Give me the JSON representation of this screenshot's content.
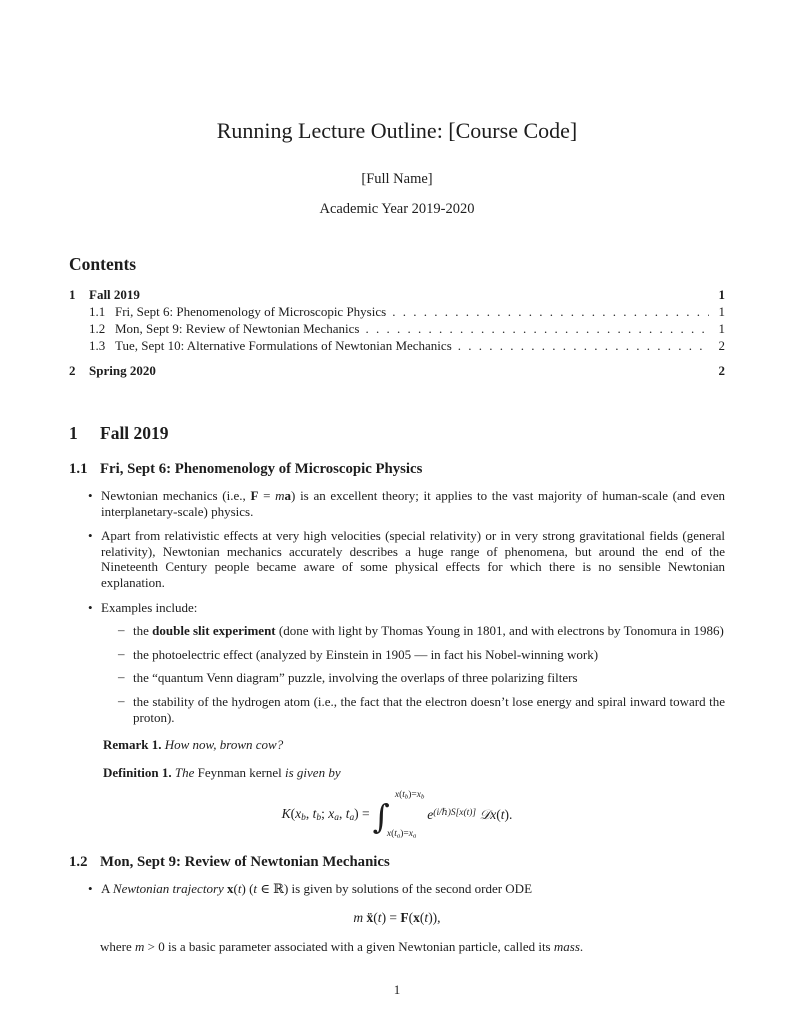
{
  "header": {
    "title": "Running Lecture Outline: [Course Code]",
    "author": "[Full Name]",
    "date": "Academic Year 2019-2020"
  },
  "toc": {
    "heading": "Contents",
    "entries": [
      {
        "num": "1",
        "label": "Fall 2019",
        "page": "1"
      },
      {
        "num": "1.1",
        "label": "Fri, Sept 6: Phenomenology of Microscopic Physics",
        "page": "1"
      },
      {
        "num": "1.2",
        "label": "Mon, Sept 9: Review of Newtonian Mechanics",
        "page": "1"
      },
      {
        "num": "1.3",
        "label": "Tue, Sept 10: Alternative Formulations of Newtonian Mechanics",
        "page": "2"
      },
      {
        "num": "2",
        "label": "Spring 2020",
        "page": "2"
      }
    ]
  },
  "sections": {
    "fall": {
      "num": "1",
      "title": "Fall 2019"
    },
    "sub11": {
      "num": "1.1",
      "title": "Fri, Sept 6: Phenomenology of Microscopic Physics"
    },
    "sub12": {
      "num": "1.2",
      "title": "Mon, Sept 9: Review of Newtonian Mechanics"
    }
  },
  "content": {
    "bullet1": [
      {
        "t": "Newtonian mechanics (i.e., "
      },
      {
        "t": "F",
        "s": "b"
      },
      {
        "t": " = "
      },
      {
        "t": "m",
        "s": "i"
      },
      {
        "t": "a",
        "s": "b"
      },
      {
        "t": ") is an excellent theory; it applies to the vast majority of human-scale (and even interplanetary-scale) physics."
      }
    ],
    "bullet2": [
      {
        "t": "Apart from relativistic effects at very high velocities (special relativity) or in very strong gravitational fields (general relativity), Newtonian mechanics accurately describes a huge range of phenomena, but around the end of the Nineteenth Century people became aware of some physical effects for which there is no sensible Newtonian explanation."
      }
    ],
    "bullet3": [
      {
        "t": "Examples include:"
      }
    ],
    "examples": [
      [
        {
          "t": "the "
        },
        {
          "t": "double slit experiment",
          "s": "b"
        },
        {
          "t": " (done with light by Thomas Young in 1801, and with electrons by Tonomura in 1986)"
        }
      ],
      [
        {
          "t": "the photoelectric effect (analyzed by Einstein in 1905 — in fact his Nobel-winning work)"
        }
      ],
      [
        {
          "t": "the “quantum Venn diagram” puzzle, involving the overlaps of three polarizing filters"
        }
      ],
      [
        {
          "t": "the stability of the hydrogen atom (i.e., the fact that the electron doesn’t lose energy and spiral inward toward the proton)."
        }
      ]
    ],
    "remark": {
      "label": "Remark 1.",
      "runs": [
        {
          "t": "How now, brown cow?",
          "s": "i"
        }
      ]
    },
    "definition": {
      "label": "Definition 1.",
      "runs": [
        {
          "t": "The ",
          "s": "i"
        },
        {
          "t": "Feynman kernel"
        },
        {
          "t": " is given by",
          "s": "i"
        }
      ]
    },
    "kernel_formula": {
      "lhs": [
        {
          "t": "K",
          "s": "i"
        },
        {
          "t": "("
        },
        {
          "t": "x",
          "s": "i"
        },
        {
          "t": "b",
          "s": "isub"
        },
        {
          "t": ", "
        },
        {
          "t": "t",
          "s": "i"
        },
        {
          "t": "b",
          "s": "isub"
        },
        {
          "t": "; "
        },
        {
          "t": "x",
          "s": "i"
        },
        {
          "t": "a",
          "s": "isub"
        },
        {
          "t": ", "
        },
        {
          "t": "t",
          "s": "i"
        },
        {
          "t": "a",
          "s": "isub"
        },
        {
          "t": ") = "
        }
      ],
      "int_sign": "∫",
      "upper": [
        {
          "t": "x",
          "s": "i"
        },
        {
          "t": "("
        },
        {
          "t": "t",
          "s": "i"
        },
        {
          "t": "b",
          "s": "isub"
        },
        {
          "t": ")="
        },
        {
          "t": "x",
          "s": "i"
        },
        {
          "t": "b",
          "s": "isub"
        }
      ],
      "lower": [
        {
          "t": "x",
          "s": "i"
        },
        {
          "t": "("
        },
        {
          "t": "t",
          "s": "i"
        },
        {
          "t": "a",
          "s": "isub"
        },
        {
          "t": ")="
        },
        {
          "t": "x",
          "s": "i"
        },
        {
          "t": "a",
          "s": "isub"
        }
      ],
      "integrand": [
        {
          "t": "e",
          "s": "i"
        },
        {
          "t": "(i/ℏ)S[x(t)]",
          "s": "isup"
        },
        {
          "t": " "
        },
        {
          "t": "𝒟",
          "s": "scr"
        },
        {
          "t": "x",
          "s": "i"
        },
        {
          "t": "("
        },
        {
          "t": "t",
          "s": "i"
        },
        {
          "t": ")."
        }
      ]
    },
    "bullet12": [
      {
        "t": "A "
      },
      {
        "t": "Newtonian trajectory ",
        "s": "i"
      },
      {
        "t": "x",
        "s": "b"
      },
      {
        "t": "("
      },
      {
        "t": "t",
        "s": "i"
      },
      {
        "t": ") ("
      },
      {
        "t": "t",
        "s": "i"
      },
      {
        "t": " ∈ ℝ) is given by solutions of the second order ODE"
      }
    ],
    "ode_formula": [
      {
        "t": "m",
        "s": "i"
      },
      {
        "t": " "
      },
      {
        "t": "ẍ",
        "s": "b"
      },
      {
        "t": "("
      },
      {
        "t": "t",
        "s": "i"
      },
      {
        "t": ") = "
      },
      {
        "t": "F",
        "s": "b"
      },
      {
        "t": "("
      },
      {
        "t": "x",
        "s": "b"
      },
      {
        "t": "("
      },
      {
        "t": "t",
        "s": "i"
      },
      {
        "t": ")),"
      }
    ],
    "closing12": [
      {
        "t": "where "
      },
      {
        "t": "m",
        "s": "i"
      },
      {
        "t": " > 0 is a basic parameter associated with a given Newtonian particle, called its "
      },
      {
        "t": "mass",
        "s": "i"
      },
      {
        "t": "."
      }
    ]
  },
  "footer": {
    "page_number": "1"
  }
}
